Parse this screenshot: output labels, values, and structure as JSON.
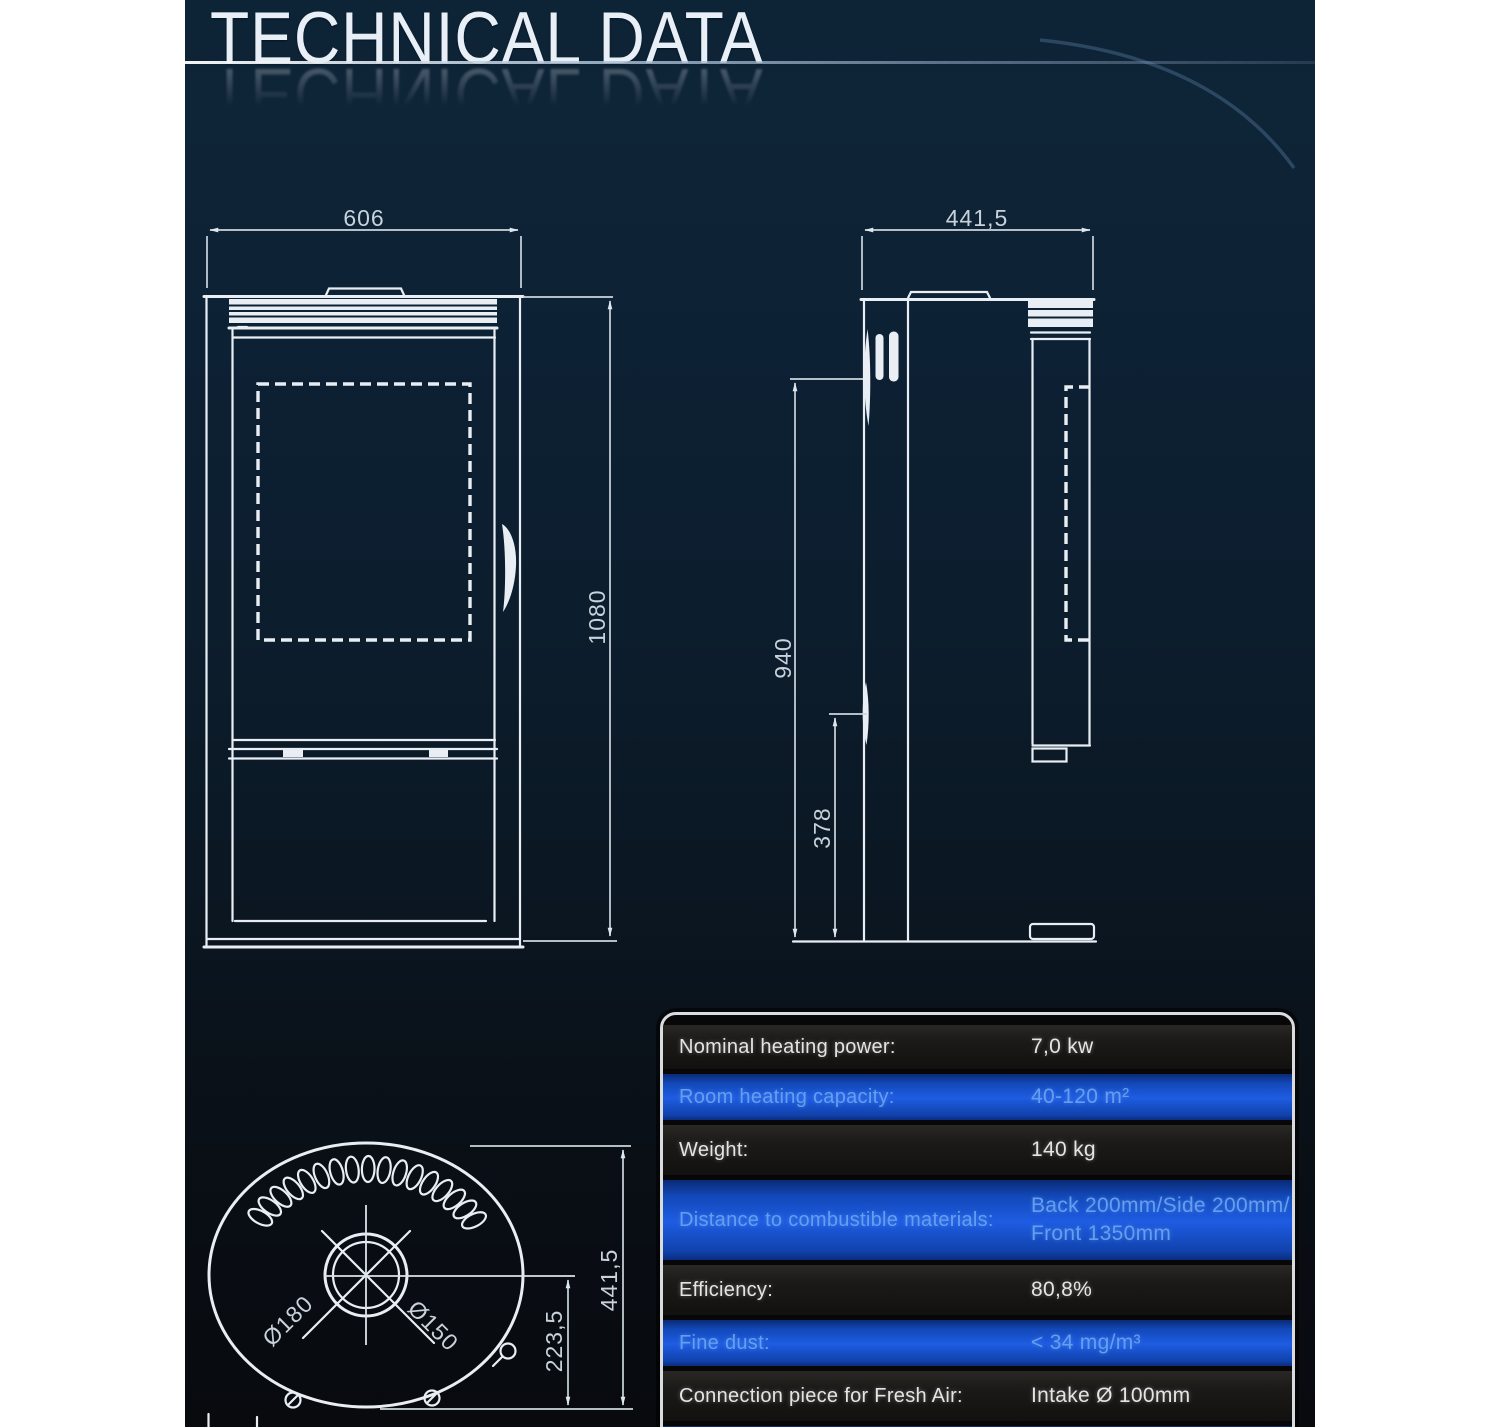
{
  "page": {
    "title": "TECHNICAL DATA"
  },
  "front_view": {
    "dims": {
      "width": "606",
      "height": "1080"
    }
  },
  "side_view": {
    "dims": {
      "depth": "441,5",
      "body_height": "940",
      "handle_height": "378"
    }
  },
  "top_view": {
    "dims": {
      "depth": "441,5",
      "center_offset": "223,5",
      "flue_outer": "Ø180",
      "flue_inner": "Ø150"
    }
  },
  "spec_table": {
    "rows": [
      {
        "label": "Nominal heating power:",
        "value": "7,0 kw"
      },
      {
        "label": "Room heating capacity:",
        "value": "40-120 m²"
      },
      {
        "label": "Weight:",
        "value": "140 kg"
      },
      {
        "label": "Distance to combustible materials:",
        "value": "Back 200mm/Side 200mm/\nFront 1350mm"
      },
      {
        "label": "Efficiency:",
        "value": "80,8%"
      },
      {
        "label": "Fine dust:",
        "value": "< 34 mg/m³"
      },
      {
        "label": "Connection piece for Fresh Air:",
        "value": "Intake Ø 100mm"
      }
    ]
  },
  "colors": {
    "background_navy": "#0d2336",
    "background_bottom": "#080a0e",
    "drawing_line": "#e8eef4",
    "table_row_blue": "#1e5ce2",
    "table_row_dark": "#1b1a18",
    "table_blue_text": "#639ff0",
    "table_border": "#d9dbdd"
  }
}
